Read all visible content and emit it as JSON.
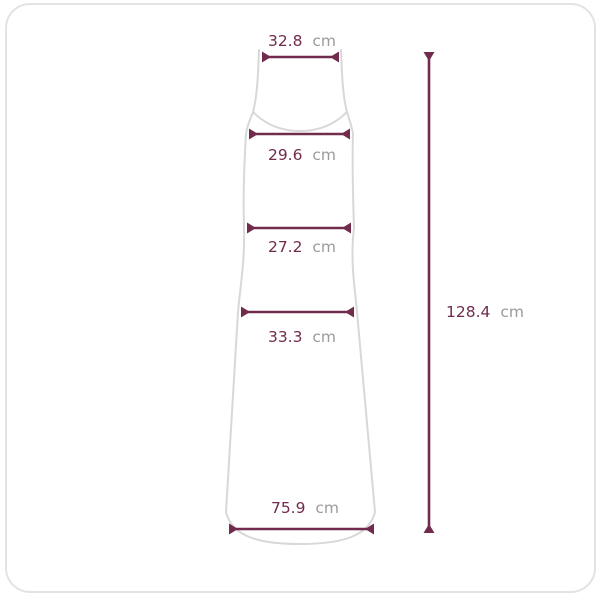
{
  "diagram": {
    "type": "garment-size-diagram",
    "garment": "sleeveless-slip-maxi-dress",
    "unit": "cm",
    "colors": {
      "measure": "#702b4d",
      "unit_text": "#9b9b9b",
      "garment_outline": "#d8d8d8",
      "frame_border": "#e3e3e3",
      "background": "#ffffff"
    },
    "measurements": {
      "shoulder_width": {
        "value": "32.8",
        "unit": "cm"
      },
      "bust_width": {
        "value": "29.6",
        "unit": "cm"
      },
      "waist_width": {
        "value": "27.2",
        "unit": "cm"
      },
      "hip_width": {
        "value": "33.3",
        "unit": "cm"
      },
      "hem_width": {
        "value": "75.9",
        "unit": "cm"
      },
      "total_length": {
        "value": "128.4",
        "unit": "cm"
      }
    }
  }
}
